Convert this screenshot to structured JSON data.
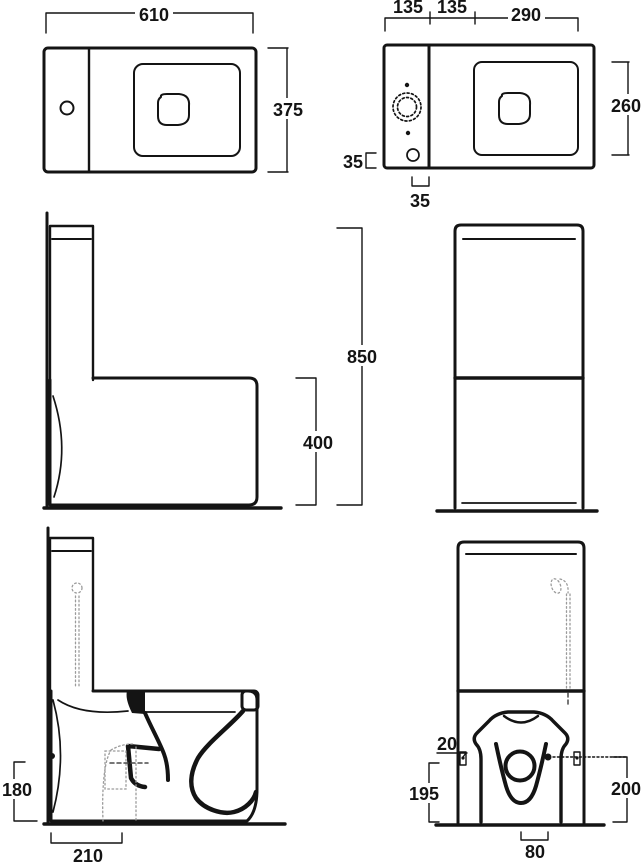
{
  "colors": {
    "ink": "#141414",
    "hidden": "#9b9b9b",
    "paper": "#ffffff"
  },
  "dims": {
    "top_view": {
      "width": "610",
      "depth": "375"
    },
    "cistern_top": {
      "seg_left": "135",
      "seg_mid": "135",
      "seg_right": "290",
      "bowl_depth": "260",
      "side_offset": "35",
      "back_offset": "35"
    },
    "side_view": {
      "total_height": "850",
      "pan_height": "400"
    },
    "section_side": {
      "outlet_height": "180",
      "outlet_setout": "210"
    },
    "section_rear": {
      "fixing_offset": "20",
      "left_height": "195",
      "right_height": "200",
      "outlet_width": "80"
    }
  }
}
